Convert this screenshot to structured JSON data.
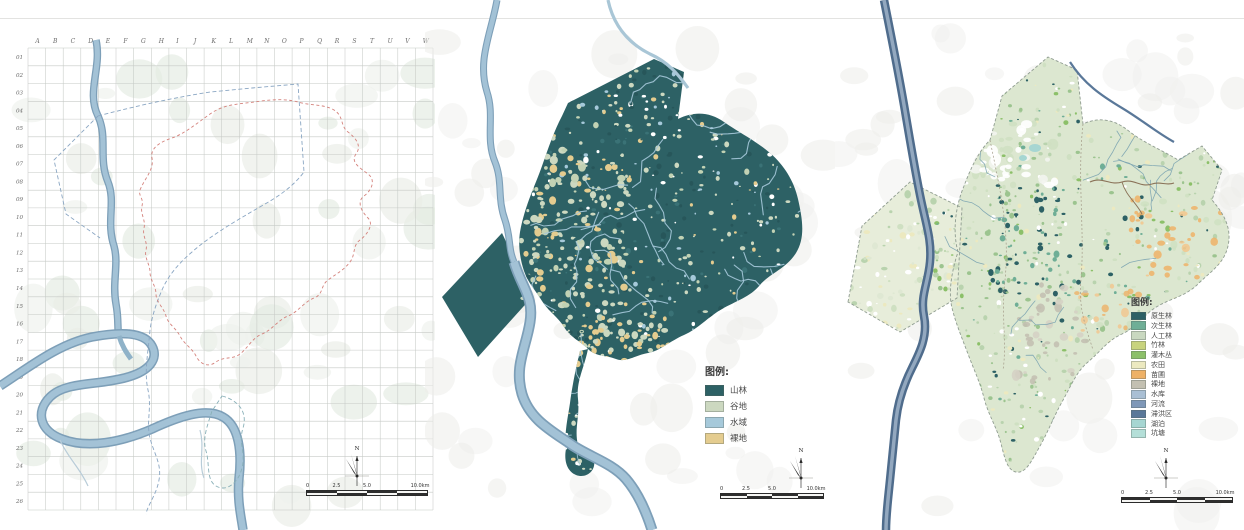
{
  "panels": {
    "grid": {
      "column_labels": [
        "A",
        "B",
        "C",
        "D",
        "E",
        "F",
        "G",
        "H",
        "I",
        "J",
        "K",
        "L",
        "M",
        "N",
        "O",
        "P",
        "Q",
        "R",
        "S",
        "T",
        "U",
        "V",
        "W"
      ],
      "row_labels": [
        "01",
        "02",
        "03",
        "04",
        "05",
        "06",
        "07",
        "08",
        "09",
        "10",
        "11",
        "12",
        "13",
        "14",
        "15",
        "16",
        "17",
        "18",
        "19",
        "20",
        "21",
        "22",
        "23",
        "24",
        "25",
        "26"
      ],
      "compass_label": "N",
      "scale_ticks": [
        "0",
        "2.5",
        "5.0",
        "10.0km"
      ]
    },
    "landform": {
      "legend_title": "图例:",
      "legend_items": [
        {
          "label": "山林",
          "color": "#2d6165"
        },
        {
          "label": "谷地",
          "color": "#ccd8c0"
        },
        {
          "label": "水域",
          "color": "#a6c9da"
        },
        {
          "label": "裸地",
          "color": "#e4cc8f"
        }
      ],
      "compass_label": "N",
      "scale_ticks": [
        "0",
        "2.5",
        "5.0",
        "10.0km"
      ]
    },
    "landcover": {
      "legend_title": "图例:",
      "legend_items": [
        {
          "label": "原生林",
          "color": "#2d6165"
        },
        {
          "label": "次生林",
          "color": "#6fae96"
        },
        {
          "label": "人工林",
          "color": "#c9d8c0"
        },
        {
          "label": "竹林",
          "color": "#c8d37d"
        },
        {
          "label": "灌木丛",
          "color": "#8cc069"
        },
        {
          "label": "农田",
          "color": "#ece9c0"
        },
        {
          "label": "苗圃",
          "color": "#eeb167"
        },
        {
          "label": "裸地",
          "color": "#c3c0b1"
        },
        {
          "label": "水库",
          "color": "#a9bfd4"
        },
        {
          "label": "河流",
          "color": "#7f98b8"
        },
        {
          "label": "滞洪区",
          "color": "#5a7899"
        },
        {
          "label": "湖泊",
          "color": "#a6d6d2"
        },
        {
          "label": "坑塘",
          "color": "#b4dfd8"
        }
      ],
      "compass_label": "N",
      "scale_ticks": [
        "0",
        "2.5",
        "5.0",
        "10.0km"
      ]
    }
  },
  "map_colors": {
    "grid_line": "#c6cac6",
    "terrain_tint": "#e9ede6",
    "river_casing": "#7d9fb8",
    "river_fill": "#a3c2d6",
    "boundary_red": "#d4827c",
    "boundary_blue": "#8aa6c3",
    "forest_dark": "#2d6165",
    "valley_sage": "#ccd8c0",
    "water_light": "#a6c9da",
    "bare_tan": "#e4cc8f",
    "dark_river_casing": "#4f6c8c",
    "dark_river_core": "#93a8bf",
    "background_mottle": "#ececea"
  }
}
